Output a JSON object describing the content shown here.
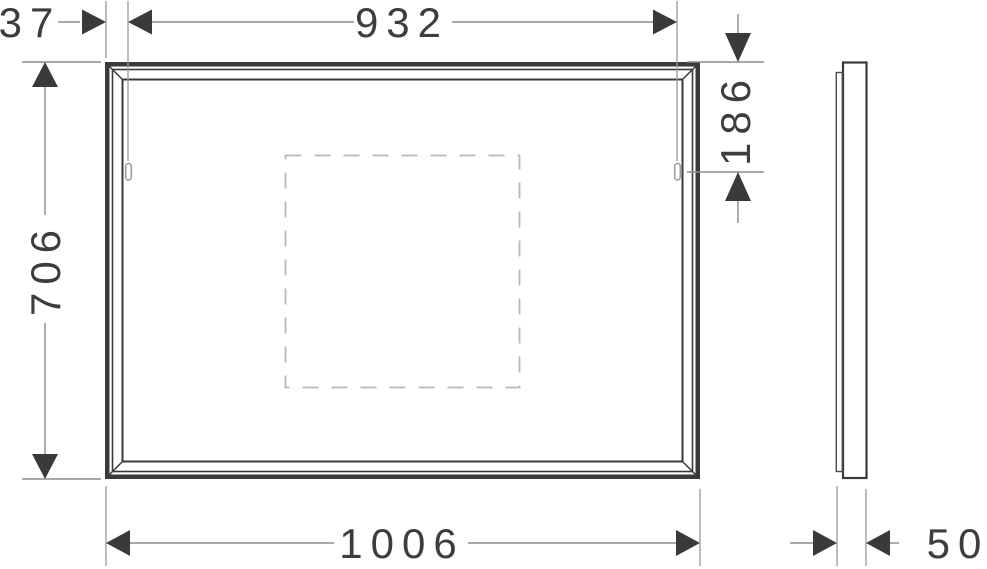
{
  "drawing": {
    "type": "technical-dimension-drawing",
    "subject": "rectangular wall mirror, front elevation and side profile",
    "units": "mm",
    "dimensions": {
      "top_offset": "37",
      "hanger_spacing": "932",
      "height": "706",
      "width": "1006",
      "hanger_from_top": "186",
      "depth": "50"
    },
    "colors": {
      "outline_dark": "#3a3a3a",
      "dim_line_gray": "#8c8c8c",
      "bracket_gray": "#9c9c9c",
      "dashed_gray": "#b8b8b8",
      "text": "#3d3d3d",
      "background": "#ffffff"
    }
  }
}
